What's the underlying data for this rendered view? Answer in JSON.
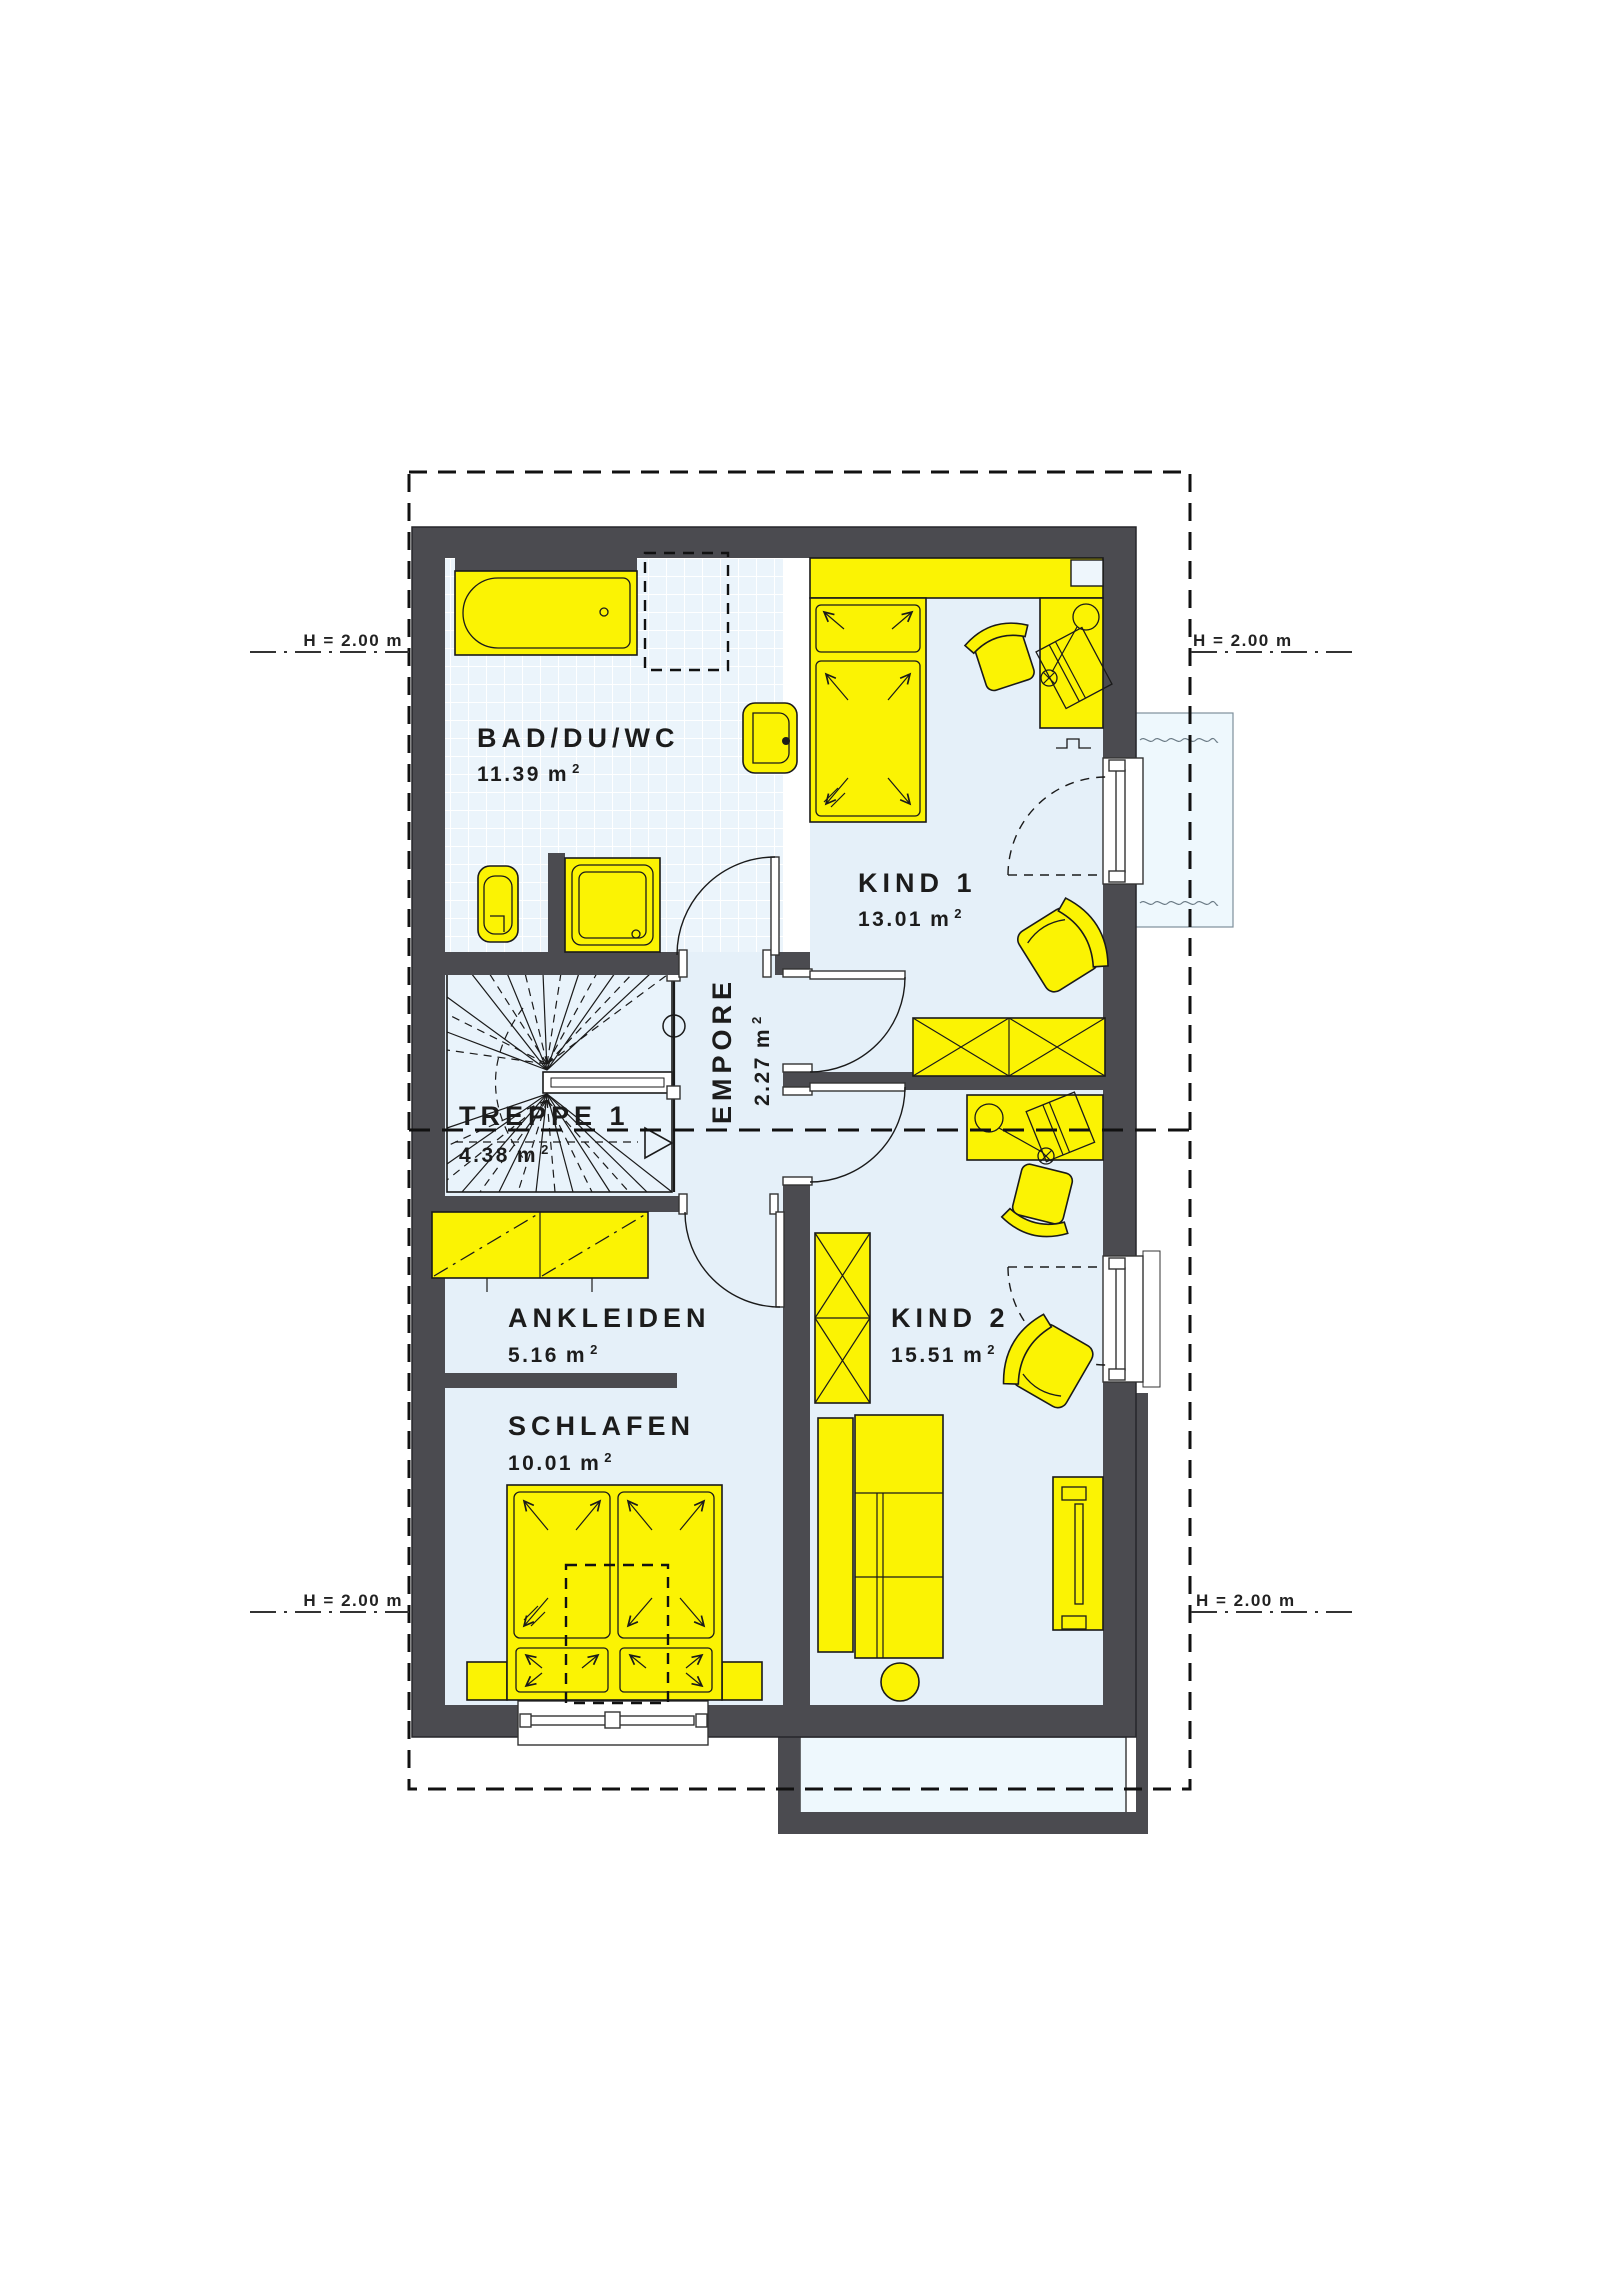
{
  "plan_title": "Obergeschoss Grundriss",
  "rooms": [
    {
      "key": "bad",
      "label": "BAD/DU/WC",
      "area": "11.39"
    },
    {
      "key": "kind1",
      "label": "KIND 1",
      "area": "13.01"
    },
    {
      "key": "treppe",
      "label": "TREPPE 1",
      "area": "4.38"
    },
    {
      "key": "empore",
      "label": "EMPORE",
      "area": "2.27"
    },
    {
      "key": "ankleiden",
      "label": "ANKLEIDEN",
      "area": "5.16"
    },
    {
      "key": "schlafen",
      "label": "SCHLAFEN",
      "area": "10.01"
    },
    {
      "key": "kind2",
      "label": "KIND 2",
      "area": "15.51"
    }
  ],
  "units": {
    "m": "m",
    "sup": "2"
  },
  "height_markers": {
    "top_left": "H = 2.00 m",
    "top_right": "H = 2.00 m",
    "bottom_left": "H = 2.00 m",
    "bottom_right": "H = 2.00 m"
  },
  "colors": {
    "wall": "#4b4b50",
    "furniture": "#fbf303",
    "floor": "#e5f0f9",
    "bath_tile": "#ebf4fb",
    "outdoor": "#eef8fd",
    "line": "#1a1a1a"
  }
}
